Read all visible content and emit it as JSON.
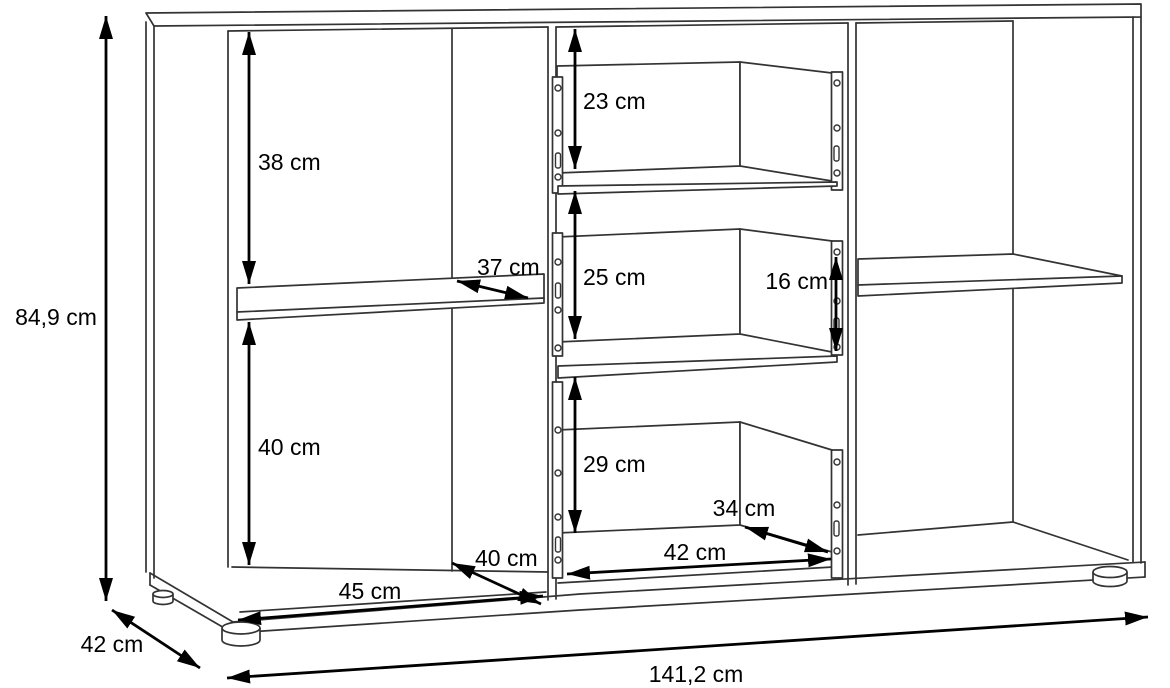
{
  "unit": "cm",
  "colors": {
    "background": "#ffffff",
    "outline": "#333333",
    "dimension_lines": "#000000",
    "text": "#000000"
  },
  "dimensions": {
    "overall": {
      "height": "84,9 cm",
      "width": "141,2 cm",
      "depth": "42 cm"
    },
    "left": {
      "upper_compartment_height": "38 cm",
      "lower_compartment_height": "40 cm",
      "shelf_depth": "37 cm",
      "compartment_width": "45 cm",
      "compartment_depth": "40 cm"
    },
    "middle": {
      "top_drawer_height": "23 cm",
      "middle_drawer_height": "25 cm",
      "bottom_drawer_height": "29 cm",
      "compartment_width": "42 cm",
      "compartment_depth": "34 cm"
    },
    "right": {
      "drawer_side_height": "16 cm"
    }
  }
}
